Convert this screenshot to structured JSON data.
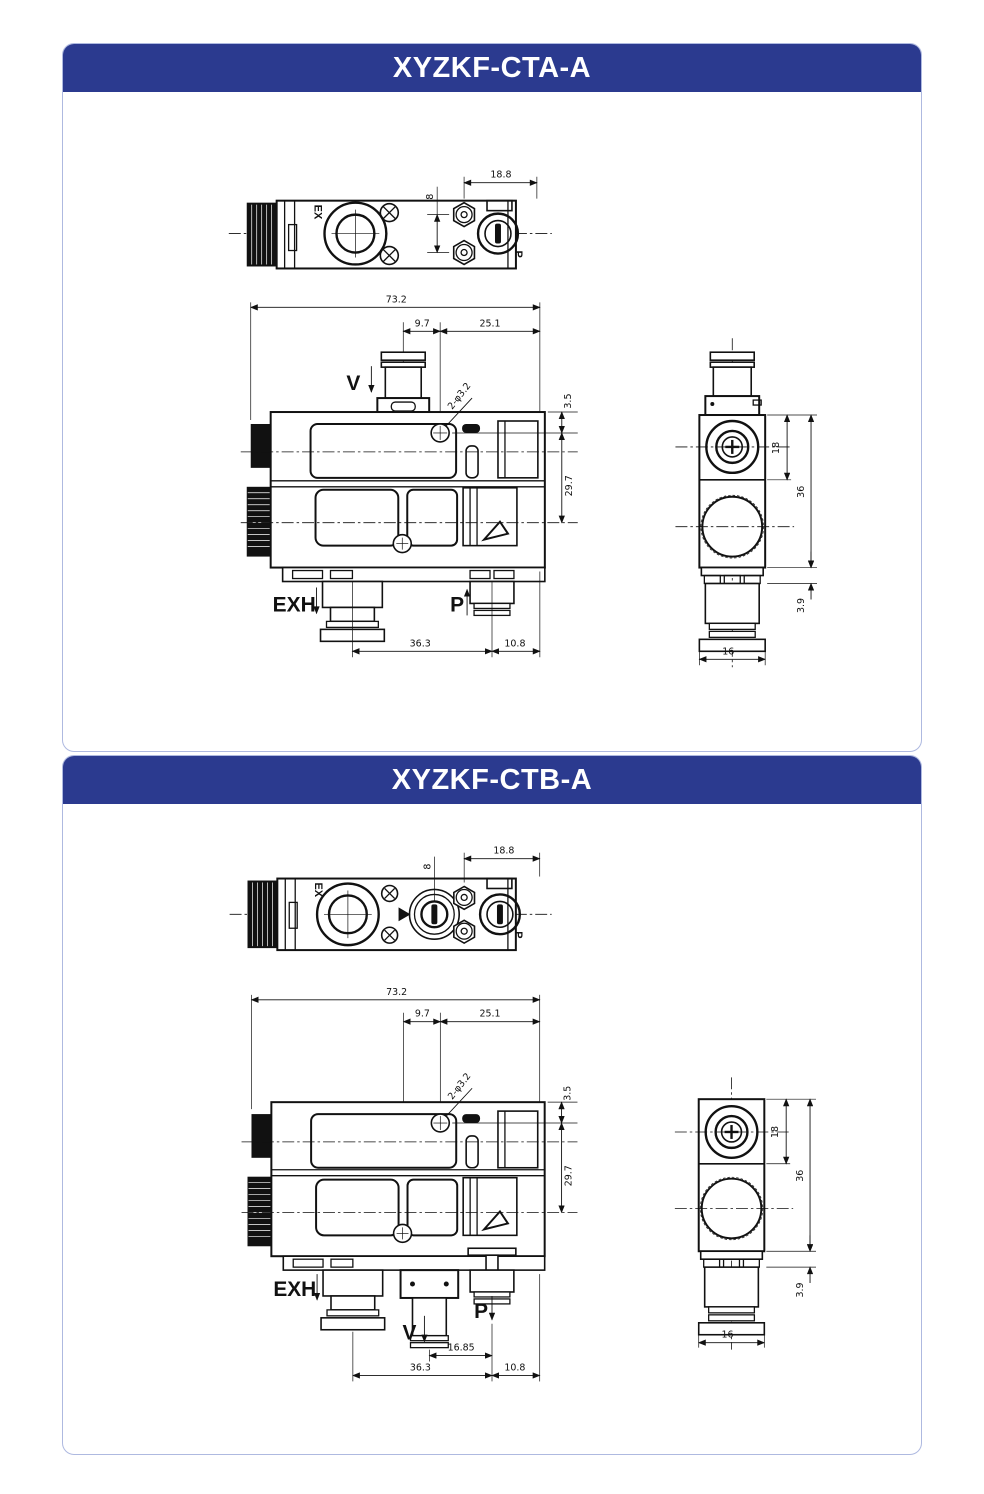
{
  "page": {
    "background": "#ffffff",
    "card_border": "#aeb9e0",
    "header_bg": "#2b3a8f",
    "header_text_color": "#ffffff",
    "line_color": "#111111"
  },
  "panel_a": {
    "title": "XYZKF-CTA-A",
    "top_view": {
      "label_ex": "EX",
      "label_p": "P",
      "dim_8": "8",
      "dim_18_8": "18.8"
    },
    "front_view": {
      "label_v": "V",
      "label_exh": "EXH",
      "label_p": "P",
      "dim_73_2": "73.2",
      "dim_9_7": "9.7",
      "dim_25_1": "25.1",
      "dim_hole": "2-φ3.2",
      "dim_3_5": "3.5",
      "dim_29_7": "29.7",
      "dim_36_3": "36.3",
      "dim_10_8": "10.8"
    },
    "side_view": {
      "dim_18": "18",
      "dim_36": "36",
      "dim_3_9": "3.9",
      "dim_16": "16"
    }
  },
  "panel_b": {
    "title": "XYZKF-CTB-A",
    "top_view": {
      "label_ex": "EX",
      "label_p": "P",
      "dim_8": "8",
      "dim_18_8": "18.8"
    },
    "front_view": {
      "label_v": "V",
      "label_exh": "EXH",
      "label_p": "P",
      "dim_73_2": "73.2",
      "dim_9_7": "9.7",
      "dim_25_1": "25.1",
      "dim_hole": "2-φ3.2",
      "dim_3_5": "3.5",
      "dim_29_7": "29.7",
      "dim_16_85": "16.85",
      "dim_36_3": "36.3",
      "dim_10_8": "10.8"
    },
    "side_view": {
      "dim_18": "18",
      "dim_36": "36",
      "dim_3_9": "3.9",
      "dim_16": "16"
    }
  }
}
